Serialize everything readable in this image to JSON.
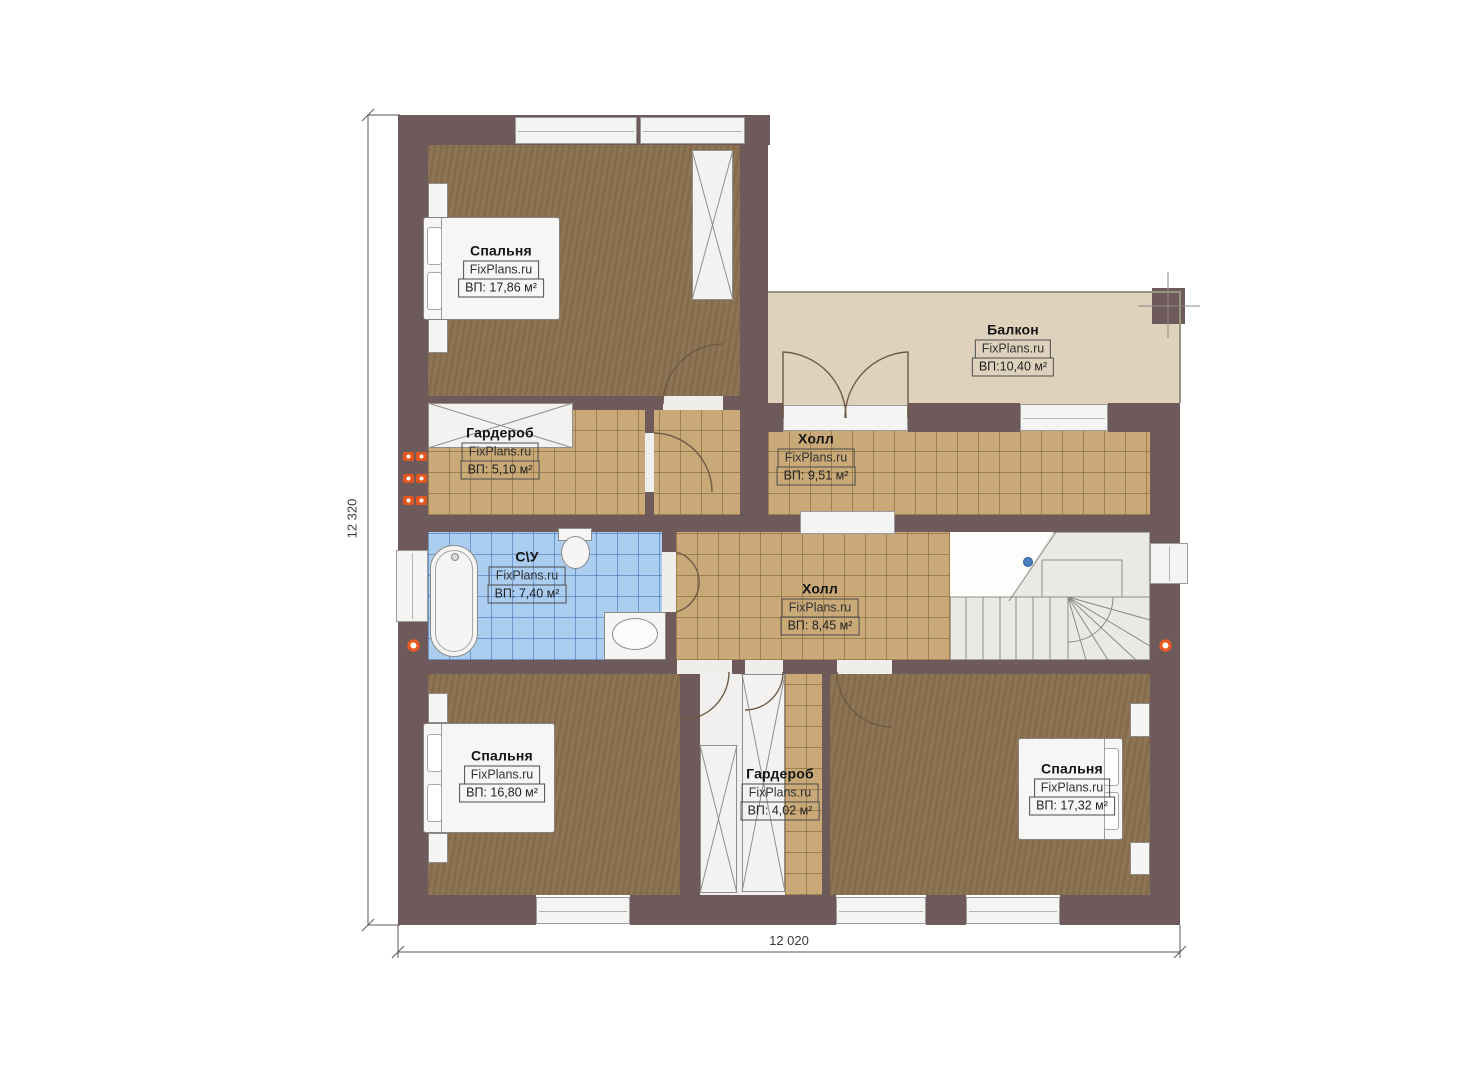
{
  "plan": {
    "brand": "FixPlans.ru",
    "floor_type": "second-floor-plan",
    "dimensions": {
      "left_total": "12 320",
      "bottom_total": "12 020"
    },
    "colors": {
      "wall": "#6e595b",
      "bedroom_floor": "#8a7150",
      "hall_tile": "#c8a977",
      "bathroom_tile": "#abcdf0",
      "balcony_floor": "#ded2bd",
      "stairs": "#eae9e6",
      "radiator_accent": "#e2571f",
      "stair_marker": "#4a7fc1"
    }
  },
  "rooms": [
    {
      "id": "bedroom-top-left",
      "name": "Спальня",
      "brand": "FixPlans.ru",
      "area": "ВП: 17,86 м²"
    },
    {
      "id": "balcony",
      "name": "Балкон",
      "brand": "FixPlans.ru",
      "area": "ВП:10,40 м²"
    },
    {
      "id": "wardrobe-top",
      "name": "Гардероб",
      "brand": "FixPlans.ru",
      "area": "ВП: 5,10 м²"
    },
    {
      "id": "hall-top",
      "name": "Холл",
      "brand": "FixPlans.ru",
      "area": "ВП: 9,51 м²"
    },
    {
      "id": "bathroom",
      "name": "С\\У",
      "brand": "FixPlans.ru",
      "area": "ВП: 7,40 м²"
    },
    {
      "id": "hall-center",
      "name": "Холл",
      "brand": "FixPlans.ru",
      "area": "ВП: 8,45 м²"
    },
    {
      "id": "bedroom-bottom-left",
      "name": "Спальня",
      "brand": "FixPlans.ru",
      "area": "ВП: 16,80 м²"
    },
    {
      "id": "wardrobe-bottom",
      "name": "Гардероб",
      "brand": "FixPlans.ru",
      "area": "ВП: 4,02 м²"
    },
    {
      "id": "bedroom-bottom-right",
      "name": "Спальня",
      "brand": "FixPlans.ru",
      "area": "ВП: 17,32 м²"
    }
  ]
}
